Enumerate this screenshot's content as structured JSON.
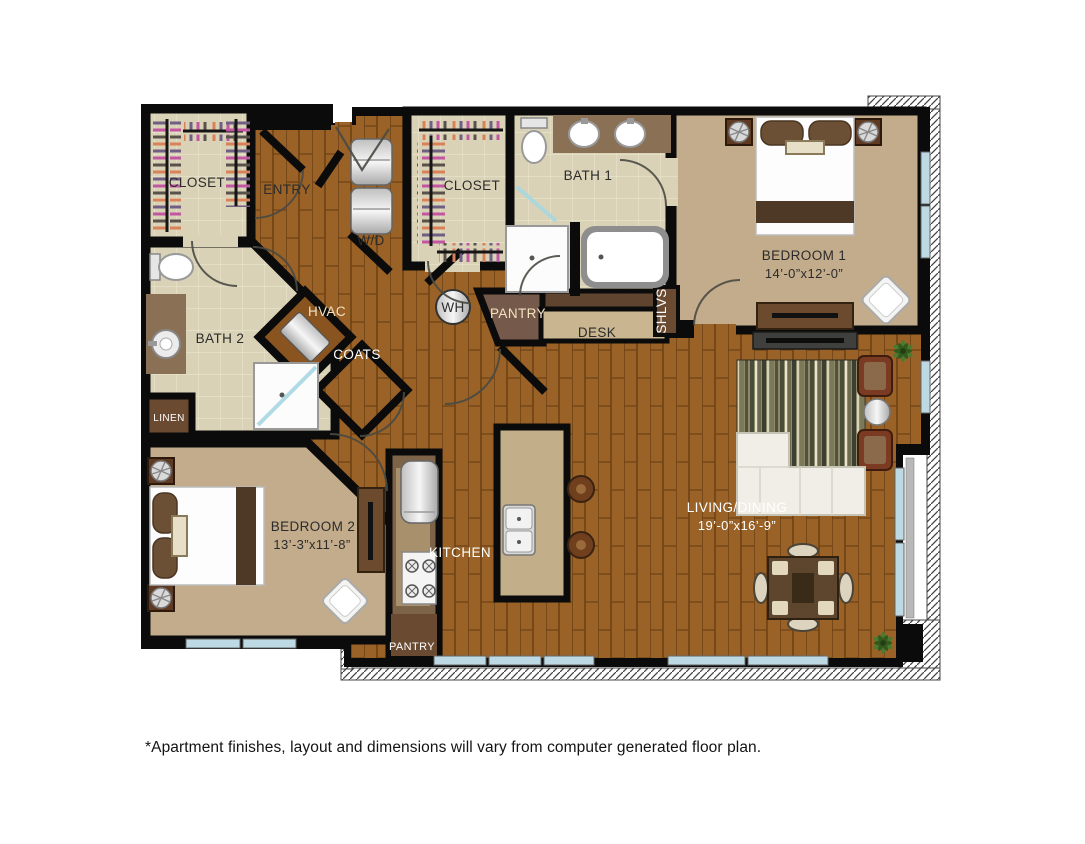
{
  "floor_plan": {
    "rooms": {
      "closet_a": {
        "label": "CLOSET"
      },
      "entry": {
        "label": "ENTRY"
      },
      "laundry": {
        "label": "W/D"
      },
      "closet_b": {
        "label": "CLOSET"
      },
      "bath_1": {
        "label": "BATH 1"
      },
      "bedroom_1": {
        "label": "BEDROOM 1",
        "dimensions": "14’-0”x12’-0”"
      },
      "bath_2": {
        "label": "BATH 2"
      },
      "hvac": {
        "label": "HVAC"
      },
      "coats": {
        "label": "COATS"
      },
      "water_heater": {
        "label": "WH"
      },
      "pantry_upper": {
        "label": "PANTRY"
      },
      "desk": {
        "label": "DESK"
      },
      "shelves": {
        "label": "SHLVS"
      },
      "linen": {
        "label": "LINEN"
      },
      "bedroom_2": {
        "label": "BEDROOM 2",
        "dimensions": "13’-3”x11’-8”"
      },
      "kitchen": {
        "label": "KITCHEN"
      },
      "pantry_lower": {
        "label": "PANTRY"
      },
      "living_dining": {
        "label": "LIVING/DINING",
        "dimensions": "19’-0”x16’-9”"
      }
    },
    "colors": {
      "wall": "#0B0B0B",
      "wood_floor": "#9A6226",
      "tile_floor": "#D9D2B6",
      "carpet": "#C3AC8B",
      "window_glass": "#BCD9E4",
      "counter": "#8A7156",
      "accent_furniture": "#6B4A2E"
    },
    "disclaimer": "*Apartment finishes, layout and dimensions will vary from computer generated floor plan."
  }
}
